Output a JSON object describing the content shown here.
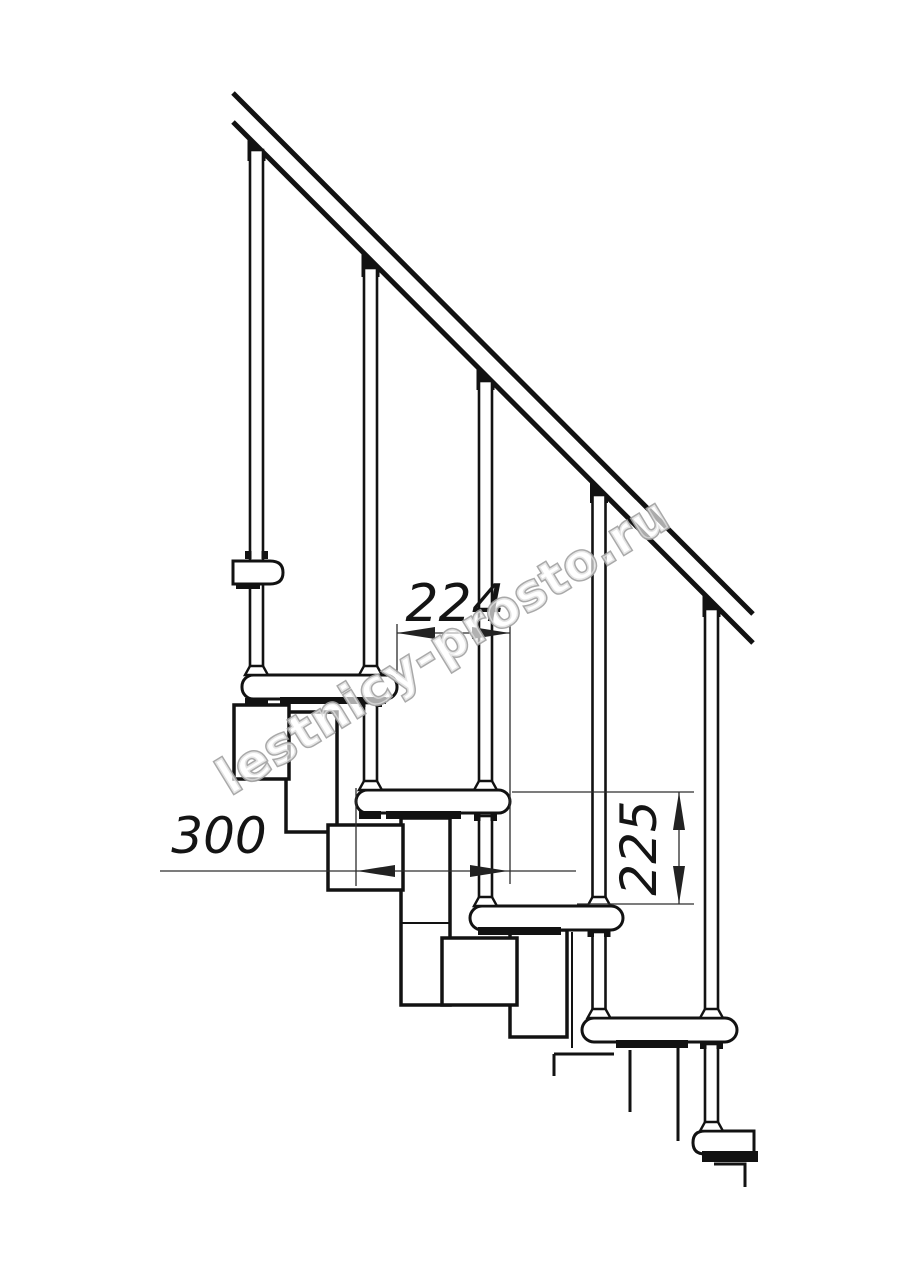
{
  "canvas": {
    "width": 914,
    "height": 1280,
    "background": "#ffffff"
  },
  "drawing": {
    "kind": "staircase-side-elevation-technical-drawing",
    "line_color": "#121212",
    "dimension_color": "#2d2d2d",
    "dimensions": {
      "step_run": "224",
      "tread_depth": "300",
      "riser_height": "225"
    },
    "watermark": {
      "text": "lestnicy-prosto.ru",
      "color": "#a2a2a2"
    }
  }
}
